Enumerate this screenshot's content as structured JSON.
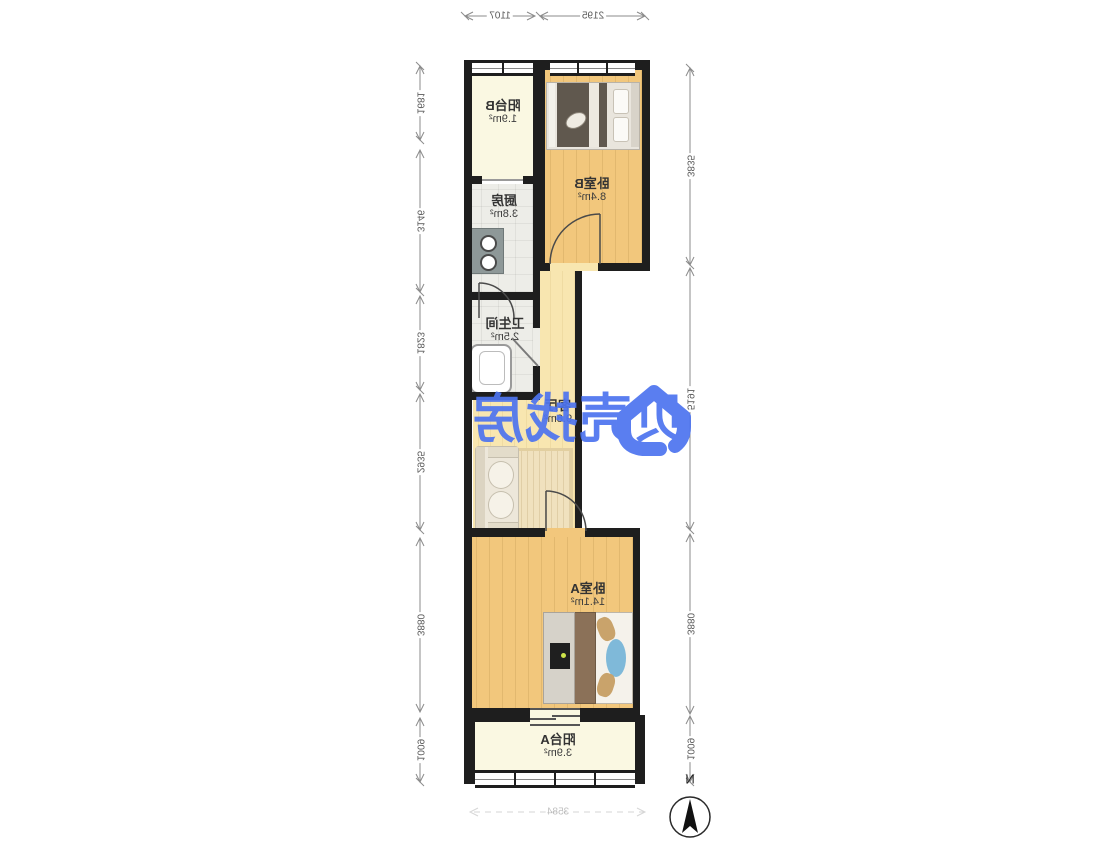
{
  "watermark": {
    "text": "贝壳找房",
    "color": "#4D74EF"
  },
  "compass": {
    "label": "N"
  },
  "rooms": {
    "balcony_b": {
      "name": "阳台B",
      "area": "1.9m²"
    },
    "kitchen": {
      "name": "厨房",
      "area": "3.8m²"
    },
    "bedroom_b": {
      "name": "卧室B",
      "area": "8.4m²"
    },
    "bathroom": {
      "name": "卫生间",
      "area": "2.5m²"
    },
    "living": {
      "name": "客厅",
      "area": "9.8m²"
    },
    "bedroom_a": {
      "name": "卧室A",
      "area": "14.1m²"
    },
    "balcony_a": {
      "name": "阳台A",
      "area": "3.9m²"
    }
  },
  "dimensions": {
    "top": [
      "2195",
      "1107"
    ],
    "left": [
      "3835",
      "5191",
      "3880",
      "1009"
    ],
    "right": [
      "1681",
      "3146",
      "1823",
      "2935",
      "3880",
      "1009"
    ],
    "bottom": [
      "3584"
    ]
  },
  "colors": {
    "wall": "#1E1E1E",
    "bedroom_floor": "#F2C77C",
    "living_floor": "#F8E6B0",
    "tile_floor": "#EDEDE8",
    "balcony_floor": "#FAF8E2",
    "watermark_blue": "#4D74EF"
  }
}
